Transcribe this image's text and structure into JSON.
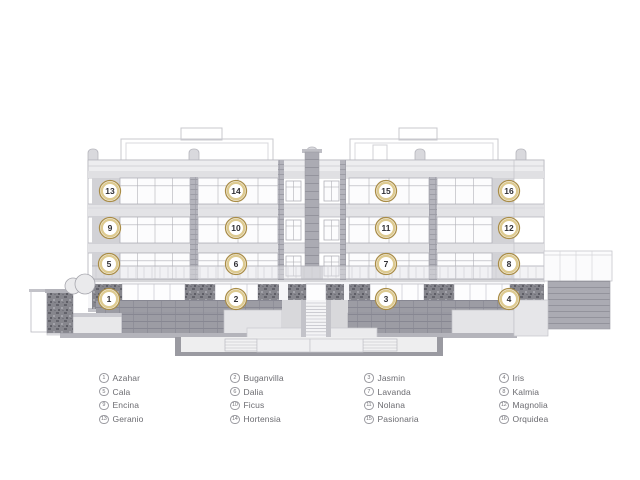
{
  "units": {
    "badges": [
      "1",
      "2",
      "3",
      "4",
      "5",
      "6",
      "7",
      "8",
      "9",
      "10",
      "11",
      "12",
      "13",
      "14",
      "15",
      "16"
    ]
  },
  "legend": {
    "columns": [
      [
        {
          "number": "1",
          "name": "Azahar"
        },
        {
          "number": "5",
          "name": "Cala"
        },
        {
          "number": "9",
          "name": "Encina"
        },
        {
          "number": "13",
          "name": "Geranio"
        }
      ],
      [
        {
          "number": "2",
          "name": "Buganvilla"
        },
        {
          "number": "6",
          "name": "Dalia"
        },
        {
          "number": "10",
          "name": "Ficus"
        },
        {
          "number": "14",
          "name": "Hortensia"
        }
      ],
      [
        {
          "number": "3",
          "name": "Jasmin"
        },
        {
          "number": "7",
          "name": "Lavanda"
        },
        {
          "number": "11",
          "name": "Nolana"
        },
        {
          "number": "15",
          "name": "Pasionaria"
        }
      ],
      [
        {
          "number": "4",
          "name": "Iris"
        },
        {
          "number": "8",
          "name": "Kalmia"
        },
        {
          "number": "12",
          "name": "Magnolia"
        },
        {
          "number": "16",
          "name": "Orquidea"
        }
      ]
    ]
  },
  "colors": {
    "badge_ring_outer": "#a98c46",
    "badge_ring_inner": "#ddca90",
    "badge_fill": "#ffffff",
    "badge_number": "#2f2f34",
    "legend_text": "#6b6b70",
    "legend_circle_border": "#9b9ba1",
    "drawing_line": "#b3b3ba"
  }
}
